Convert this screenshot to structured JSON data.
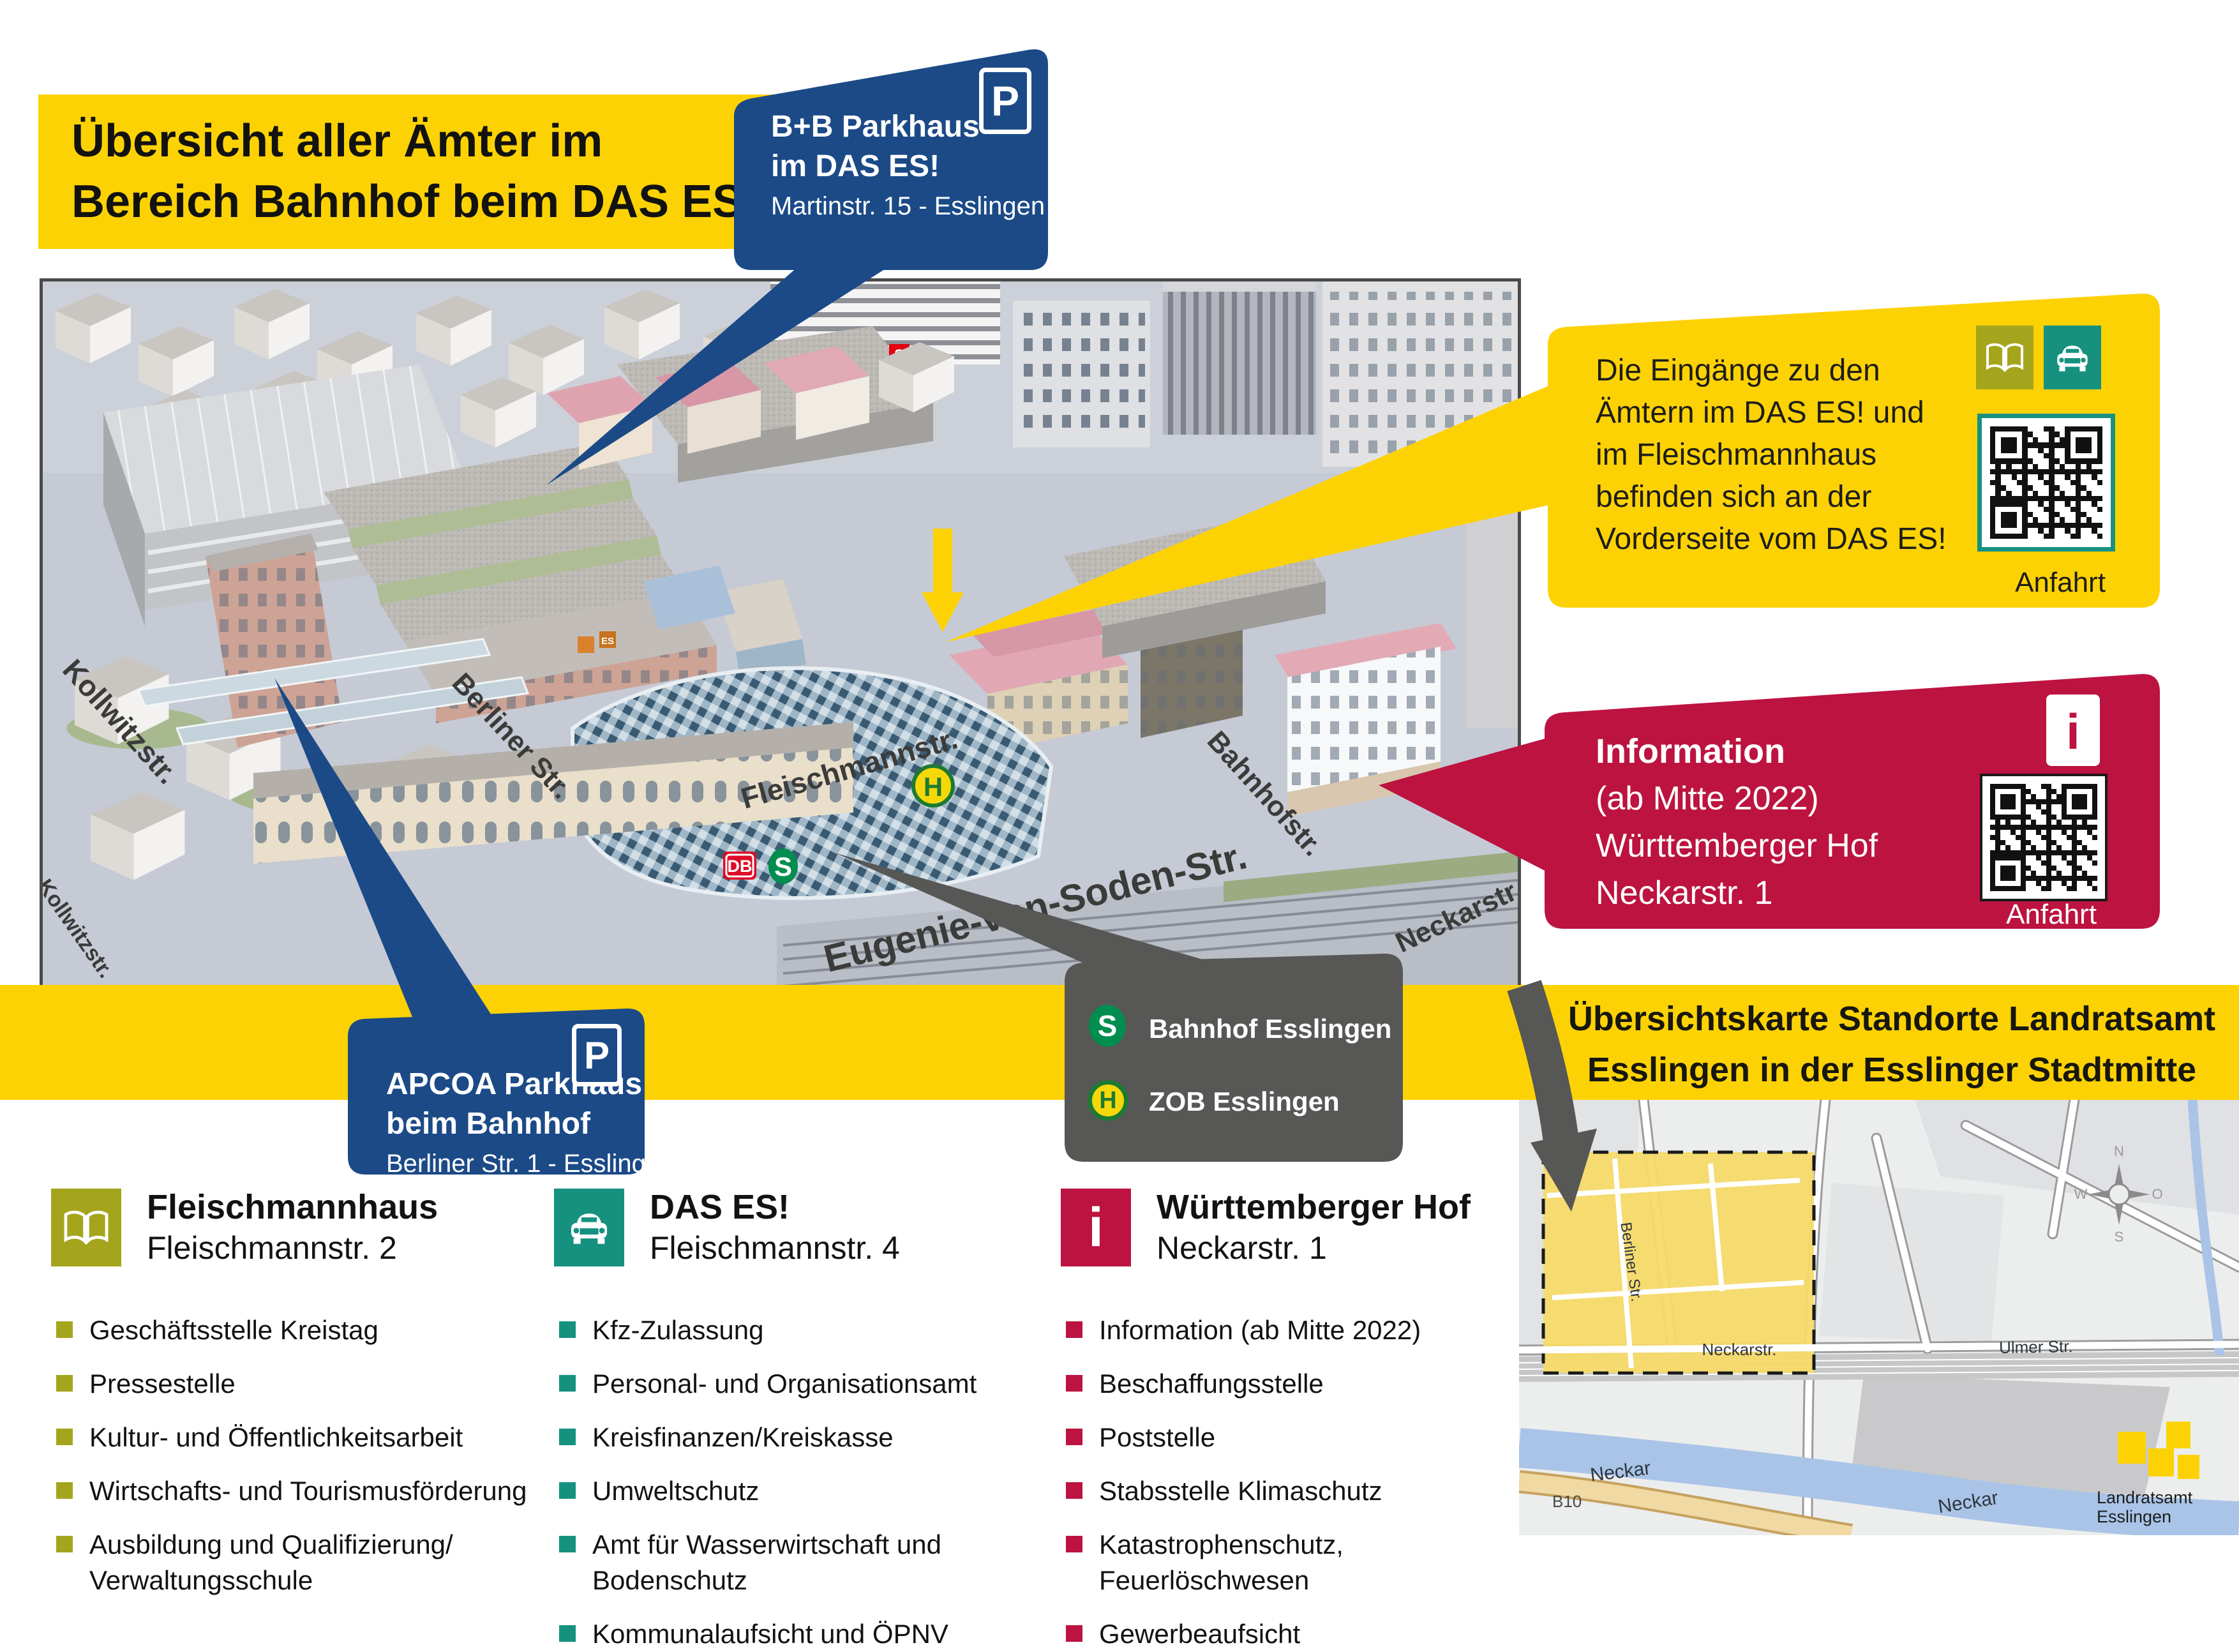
{
  "title": {
    "line1": "Übersicht aller Ämter im",
    "line2": "Bereich Bahnhof beim DAS ES!"
  },
  "callouts": {
    "bb_parkhaus": {
      "sign": "P",
      "name_line1": "B+B Parkhaus",
      "name_line2": "im DAS ES!",
      "address": "Martinstr. 15 - Esslingen"
    },
    "apcoa": {
      "sign": "P",
      "name_line1": "APCOA Parkhaus",
      "name_line2": "beim Bahnhof",
      "address": "Berliner Str. 1 - Esslingen"
    },
    "entrances_note": {
      "line1": "Die Eingänge zu den",
      "line2": "Ämtern im DAS ES! und",
      "line3": "im Fleischmannhaus",
      "line4": "befinden sich an der",
      "line5": "Vorderseite vom DAS ES!",
      "qr_label": "Anfahrt"
    },
    "information": {
      "sign": "i",
      "line1": "Information",
      "line2": "(ab Mitte 2022)",
      "line3": "Württemberger Hof",
      "line4": "Neckarstr. 1",
      "qr_label": "Anfahrt"
    },
    "transit": {
      "s_glyph": "S",
      "sbahn_label": "Bahnhof Esslingen",
      "h_glyph": "H",
      "zob_label": "ZOB Esslingen"
    }
  },
  "map": {
    "street_labels": {
      "kollwitz1": "Kollwitzstr.",
      "kollwitz2": "Kollwitzstr.",
      "berliner": "Berliner Str.",
      "fleischmann": "Fleischmannstr.",
      "bahnhof": "Bahnhofstr.",
      "neckar": "Neckarstr.",
      "eugenie": "Eugenie-von-Soden-Str."
    },
    "logos": {
      "db": "DB",
      "sbahn": "S",
      "bus": "H",
      "sparkasse": "S",
      "es": "ES"
    }
  },
  "legend": {
    "columns": [
      {
        "icon": "book-icon",
        "name": "Fleischmannhaus",
        "address": "Fleischmannstr. 2",
        "items": [
          "Geschäftsstelle Kreistag",
          "Pressestelle",
          "Kultur- und Öffentlichkeitsarbeit",
          "Wirtschafts- und Tourismusförderung",
          "Ausbildung und Qualifizierung/ Verwaltungsschule"
        ]
      },
      {
        "icon": "car-icon",
        "name": "DAS ES!",
        "address": "Fleischmannstr. 4",
        "items": [
          "Kfz-Zulassung",
          "Personal- und Organisationsamt",
          "Kreisfinanzen/Kreiskasse",
          "Umweltschutz",
          "Amt für Wasserwirtschaft und Bodenschutz",
          "Kommunalaufsicht und ÖPNV"
        ]
      },
      {
        "icon": "info-icon",
        "name": "Württemberger Hof",
        "address": "Neckarstr. 1",
        "items": [
          "Information (ab Mitte 2022)",
          "Beschaffungsstelle",
          "Poststelle",
          "Stabsstelle Klimaschutz",
          "Katastrophenschutz, Feuerlöschwesen",
          "Gewerbeaufsicht"
        ]
      }
    ]
  },
  "overview_map": {
    "heading_line1": "Übersichtskarte Standorte Landratsamt",
    "heading_line2": "Esslingen in der Esslinger Stadtmitte",
    "labels": {
      "berliner": "Berliner Str.",
      "neckarstr": "Neckarstr.",
      "ulmer": "Ulmer Str.",
      "neckar_left": "Neckar",
      "neckar_right": "Neckar",
      "b10": "B10",
      "landratsamt_line1": "Landratsamt",
      "landratsamt_line2": "Esslingen",
      "compass_n": "N",
      "compass_o": "O",
      "compass_s": "S",
      "compass_w": "W"
    }
  },
  "colors": {
    "accent_yellow": "#FDD205",
    "callout_blue": "#1B4A87",
    "callout_red": "#BC1340",
    "callout_gray": "#575756",
    "olive": "#A4A51C",
    "teal": "#169180",
    "sbahn_green": "#008D4F",
    "bus_green": "#1D7A33",
    "bus_yellow": "#F6D809",
    "db_red": "#DF0B26"
  }
}
